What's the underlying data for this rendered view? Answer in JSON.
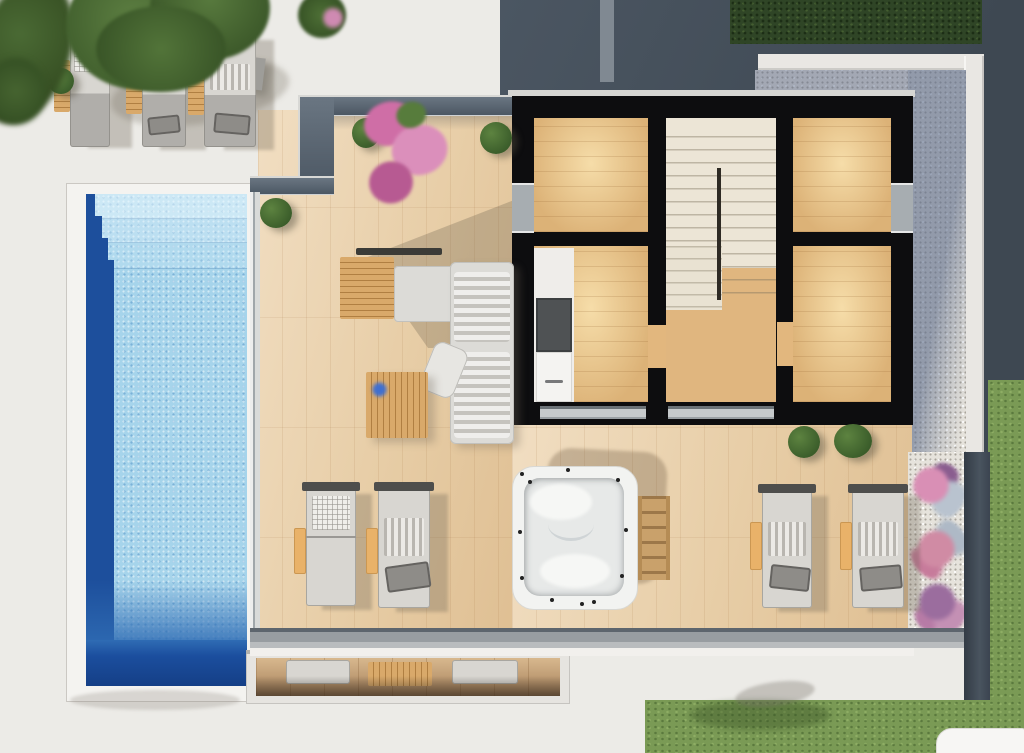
{
  "scene": {
    "type": "architectural-floor-plan-3d-render",
    "view": "top-down",
    "subject": "villa upper level with pool terrace, hot tub and garden"
  },
  "palette": {
    "concrete": "#ecebe7",
    "slate": "#47525d",
    "hedge": "#2f4526",
    "canopy": "#4f7038",
    "bush": "#3a5c2a",
    "lawn": "#7a9a55",
    "gravelLight": "#e6e3dc",
    "gravelShadow": "#76839b",
    "curb": "#e9e7e3",
    "wallBand": "#39424d",
    "poolCoping": "#f4f3f0",
    "poolWater": "#a6d4eb",
    "poolStep": "#c4e3f3",
    "poolDeep": "#1d4f9c",
    "poolMid": "#2f6cb4",
    "deckWood": "#ead2b0",
    "roomWood": "#dcb277",
    "roomWoodBright": "#f6dda9",
    "stairCream": "#ece5d6",
    "wall": "#0d0d0f",
    "glassRail": "#56626e",
    "bottomRail": "#8e9397",
    "sofa": "#dcdbd7",
    "loungerBody": "#d8d6d1",
    "loungerDark": "#b0aeaa",
    "frameDark": "#4e4e4c",
    "bagGray": "#8e8c88",
    "towel": "#e9b269",
    "slatWood": "#d9a96a",
    "slatLine": "#b07f42",
    "tubWhite": "#f2f3f1",
    "tubInner": "#e7e9e8",
    "flowerPink": "#d98fb5",
    "flowerPurple": "#9b6d9e"
  },
  "objects": {
    "pool": "mosaic swimming pool with entry steps and dark deep end",
    "terrace": "wooden roof-terrace deck",
    "hot_tub": "square white hot tub with jets and wooden ladder",
    "sun_loungers_upper_deck": 3,
    "sun_loungers_terrace": 4,
    "side_tables": 3,
    "sofa": "L-shaped outdoor sofa with striped cushions",
    "coffee_table": "wooden slat coffee table",
    "outdoor_bench": "wooden slat bench",
    "house": {
      "wood_rooms": 4,
      "staircase": 1,
      "kitchen_counter": 1,
      "windows": 2,
      "glass_doors": 2
    },
    "landscaping": {
      "bushes": 5,
      "bougainvillea": 1,
      "flower_clusters": 3,
      "hedge": 1,
      "lawn": 1,
      "tree_canopy": 1
    },
    "lower_level_balcony": "cutaway glimpse of floor below with loungers and table"
  }
}
